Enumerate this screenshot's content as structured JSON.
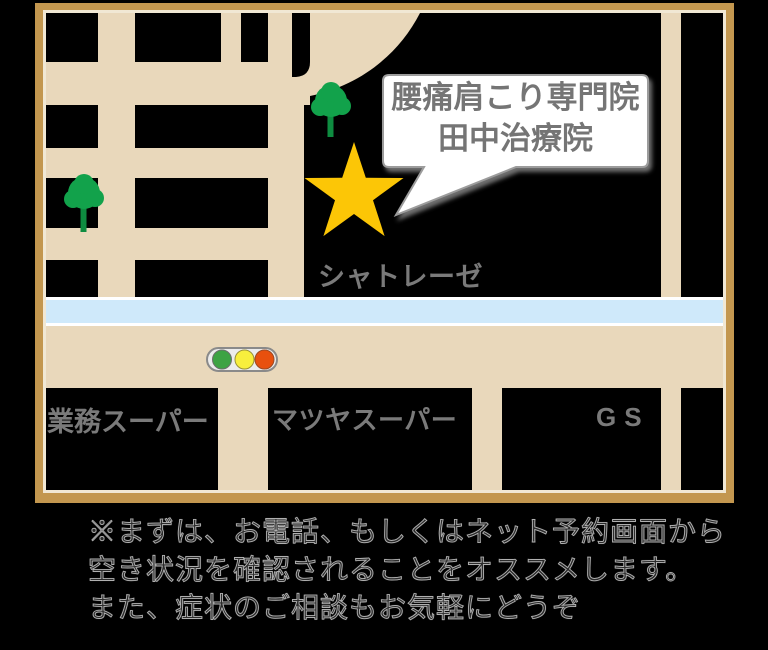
{
  "map": {
    "frame_color": "#c3974f",
    "frame_stripe_color": "#f1e8d4",
    "road_color": "#e9d8bb",
    "river_color": "#cfe9fa",
    "building_color": "#000000",
    "star_color": "#fcc606",
    "tree_crown_color": "#12a24b",
    "tree_trunk_color": "#0e8c40",
    "bubble": {
      "line1": "腰痛肩こり専門院",
      "line2": "田中治療院",
      "fill": "#ffffff",
      "border_color": "#9c9c9c",
      "text_color": "#757575"
    },
    "labels": {
      "chatelaise": "シャトレーゼ",
      "gyomu_super": "業務スーパー",
      "matsuya_super": "マツヤスーパー",
      "gas_station": "GS",
      "color": "#7a7a7a"
    },
    "traffic_light": {
      "housing": "#ececec",
      "green": "#3da344",
      "yellow": "#f8ef3d",
      "red": "#e8500e"
    },
    "icons": {
      "location": "star-icon",
      "vegetation": "tree-icon",
      "signal": "traffic-light-icon"
    }
  },
  "note": {
    "line1": "※まずは、お電話、もしくはネット予約画面から",
    "line2": "空き状況を確認されることをオススメします。",
    "line3": "また、症状のご相談もお気軽にどうぞ"
  }
}
